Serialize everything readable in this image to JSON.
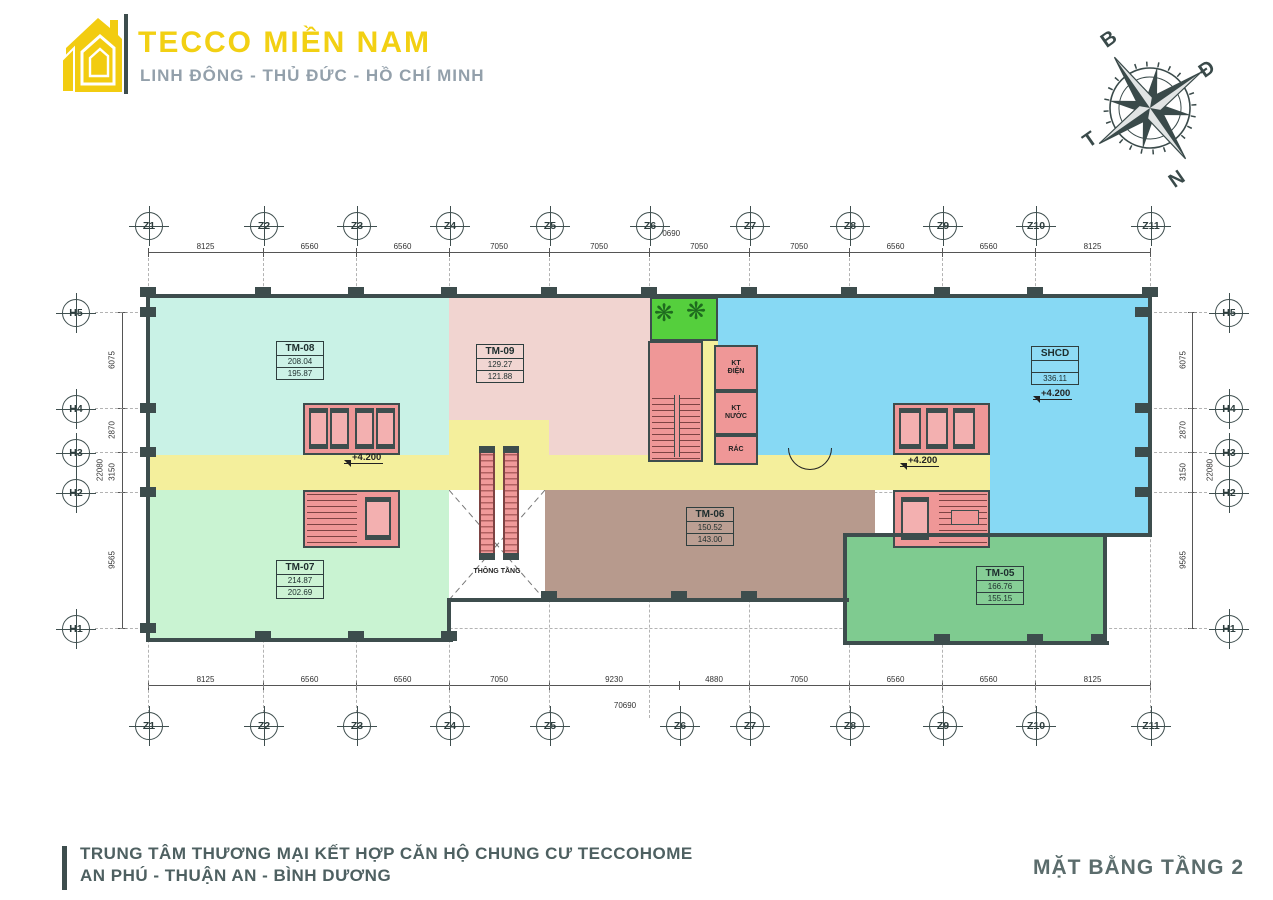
{
  "header": {
    "brand": "TECCO MIỀN NAM",
    "location": "LINH ĐÔNG - THỦ ĐỨC - HỒ CHÍ MINH"
  },
  "compass": {
    "north": "B",
    "east": "Đ",
    "south": "N",
    "west": "T"
  },
  "plan": {
    "grid": {
      "x_axes": [
        "Z1",
        "Z2",
        "Z3",
        "Z4",
        "Z5",
        "Z6",
        "Z7",
        "Z8",
        "Z9",
        "Z10",
        "Z11"
      ],
      "y_axes": [
        "H5",
        "H4",
        "H3",
        "H2",
        "H1"
      ],
      "top_dims": [
        "8125",
        "6560",
        "6560",
        "7050",
        "7050",
        "7050",
        "7050",
        "6560",
        "6560",
        "8125"
      ],
      "bottom_dims": [
        "8125",
        "6560",
        "6560",
        "7050",
        "9230",
        "4880",
        "7050",
        "6560",
        "6560",
        "8125"
      ],
      "side_dims": [
        "6075",
        "2870",
        "3150",
        "9565"
      ],
      "total_width": "70690",
      "total_height": "22080"
    },
    "units": [
      {
        "id": "TM-08",
        "area_gross": "208.04",
        "area_net": "195.87",
        "color": "#c9f2e6"
      },
      {
        "id": "TM-09",
        "area_gross": "129.27",
        "area_net": "121.88",
        "color": "#f1d4d0"
      },
      {
        "id": "SHCD",
        "area_gross": "",
        "area_net": "336.11",
        "color": "#87d9f4"
      },
      {
        "id": "TM-07",
        "area_gross": "214.87",
        "area_net": "202.69",
        "color": "#c9f3d2"
      },
      {
        "id": "TM-06",
        "area_gross": "150.52",
        "area_net": "143.00",
        "color": "#b79a8d"
      },
      {
        "id": "TM-05",
        "area_gross": "166.76",
        "area_net": "155.15",
        "color": "#7fcb90"
      }
    ],
    "labels": {
      "level_mark": "+4.200",
      "void": "THÔNG TẦNG",
      "kt_dien": "KT\nĐIỆN",
      "kt_nuoc": "KT\nNƯỚC",
      "rac": "RÁC"
    },
    "colors": {
      "corridor": "#f4ef9c",
      "garden": "#55cf3d",
      "core": "#ef9797",
      "wall": "#3d4d4d"
    }
  },
  "footer": {
    "title_line1": "TRUNG TÂM THƯƠNG MẠI KẾT HỢP CĂN HỘ CHUNG CƯ TECCOHOME",
    "title_line2": "AN PHÚ - THUẬN AN - BÌNH DƯƠNG",
    "drawing_title": "MẶT BẰNG TẦNG 2"
  }
}
